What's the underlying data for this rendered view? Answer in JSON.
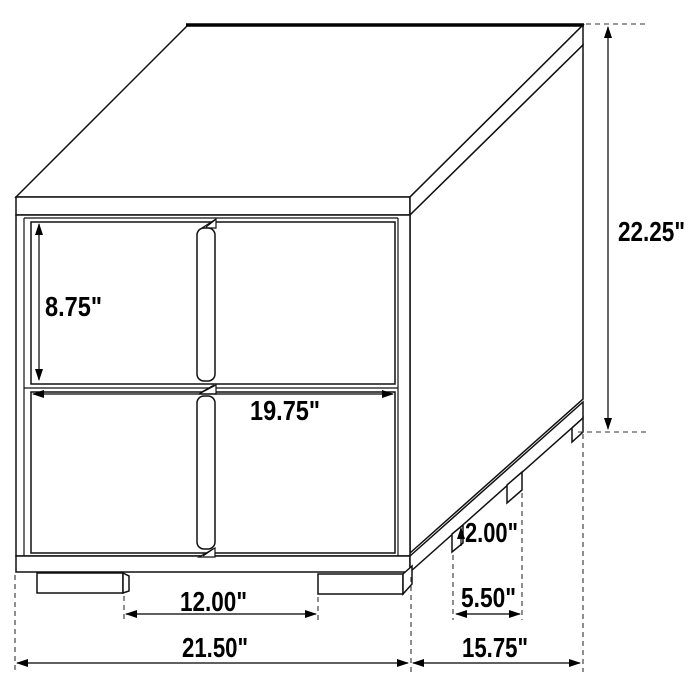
{
  "diagram": {
    "background_color": "#ffffff",
    "line_color": "#000000",
    "units": "inches",
    "dimensions": {
      "drawer_height": "8.75\"",
      "overall_height": "22.25\"",
      "drawer_width": "19.75\"",
      "leg_height": "2.00\"",
      "side_leg_spacing": "5.50\"",
      "front_leg_spacing": "12.00\"",
      "overall_width": "21.50\"",
      "overall_depth": "15.75\""
    }
  }
}
